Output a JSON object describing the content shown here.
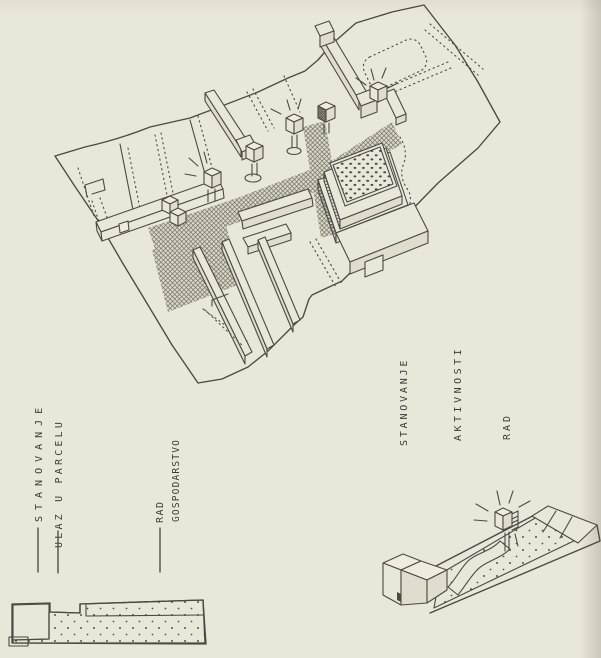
{
  "artwork": {
    "kind": "hand-drawn axonometric site sketch",
    "colors": {
      "paper": "#e9e6da",
      "ink": "#4c4a40",
      "hatch": "#62605a",
      "text": "#3e3c34"
    }
  },
  "left_legend": {
    "items": [
      {
        "id": "stanovanje",
        "label": "STANOVANJE"
      },
      {
        "id": "ulaz-u-parcelu",
        "label": "ULAZ U PARCELU"
      },
      {
        "id": "rad-gospodarstvo",
        "line1": "RAD",
        "line2": "GOSPODARSTVO"
      }
    ]
  },
  "right_legend": {
    "items": [
      {
        "id": "stanovanje",
        "label": "STANOVANJE"
      },
      {
        "id": "aktivnosti",
        "label": "AKTIVNOSTI"
      },
      {
        "id": "rad",
        "label": "RAD"
      }
    ]
  }
}
